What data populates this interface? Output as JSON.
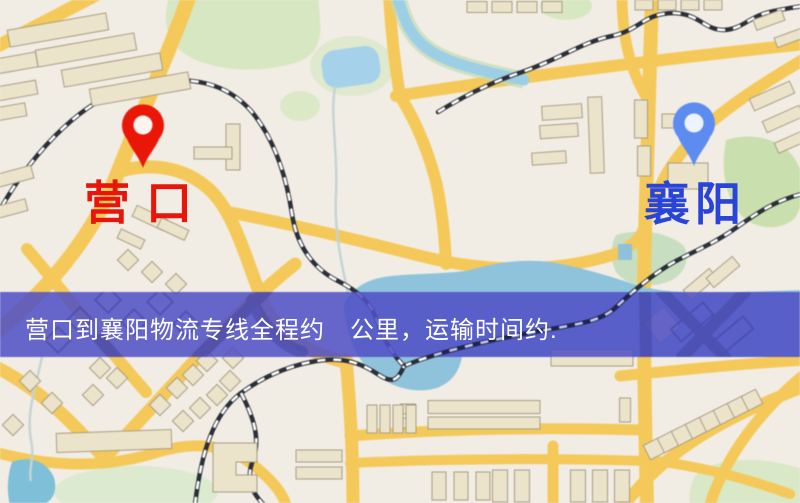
{
  "map": {
    "origin_marker": {
      "label": "营口",
      "pin_color": "#ea1708",
      "label_color": "#e8150a",
      "icon": "map-pin-icon"
    },
    "destination_marker": {
      "label": "襄阳",
      "pin_color": "#5d8cf0",
      "label_color": "#2945d9",
      "icon": "map-pin-icon"
    },
    "banner": {
      "text": "营口到襄阳物流专线全程约　公里，运输时间约.",
      "background": "#5050c6",
      "text_color": "#ffffff"
    },
    "legend_colors": {
      "road": "#f4c95a",
      "water": "#8fc3dc",
      "park": "#d7e7c2",
      "railway": "#2a2f38",
      "building": "#ece3cb",
      "background": "#f2ede4"
    }
  }
}
